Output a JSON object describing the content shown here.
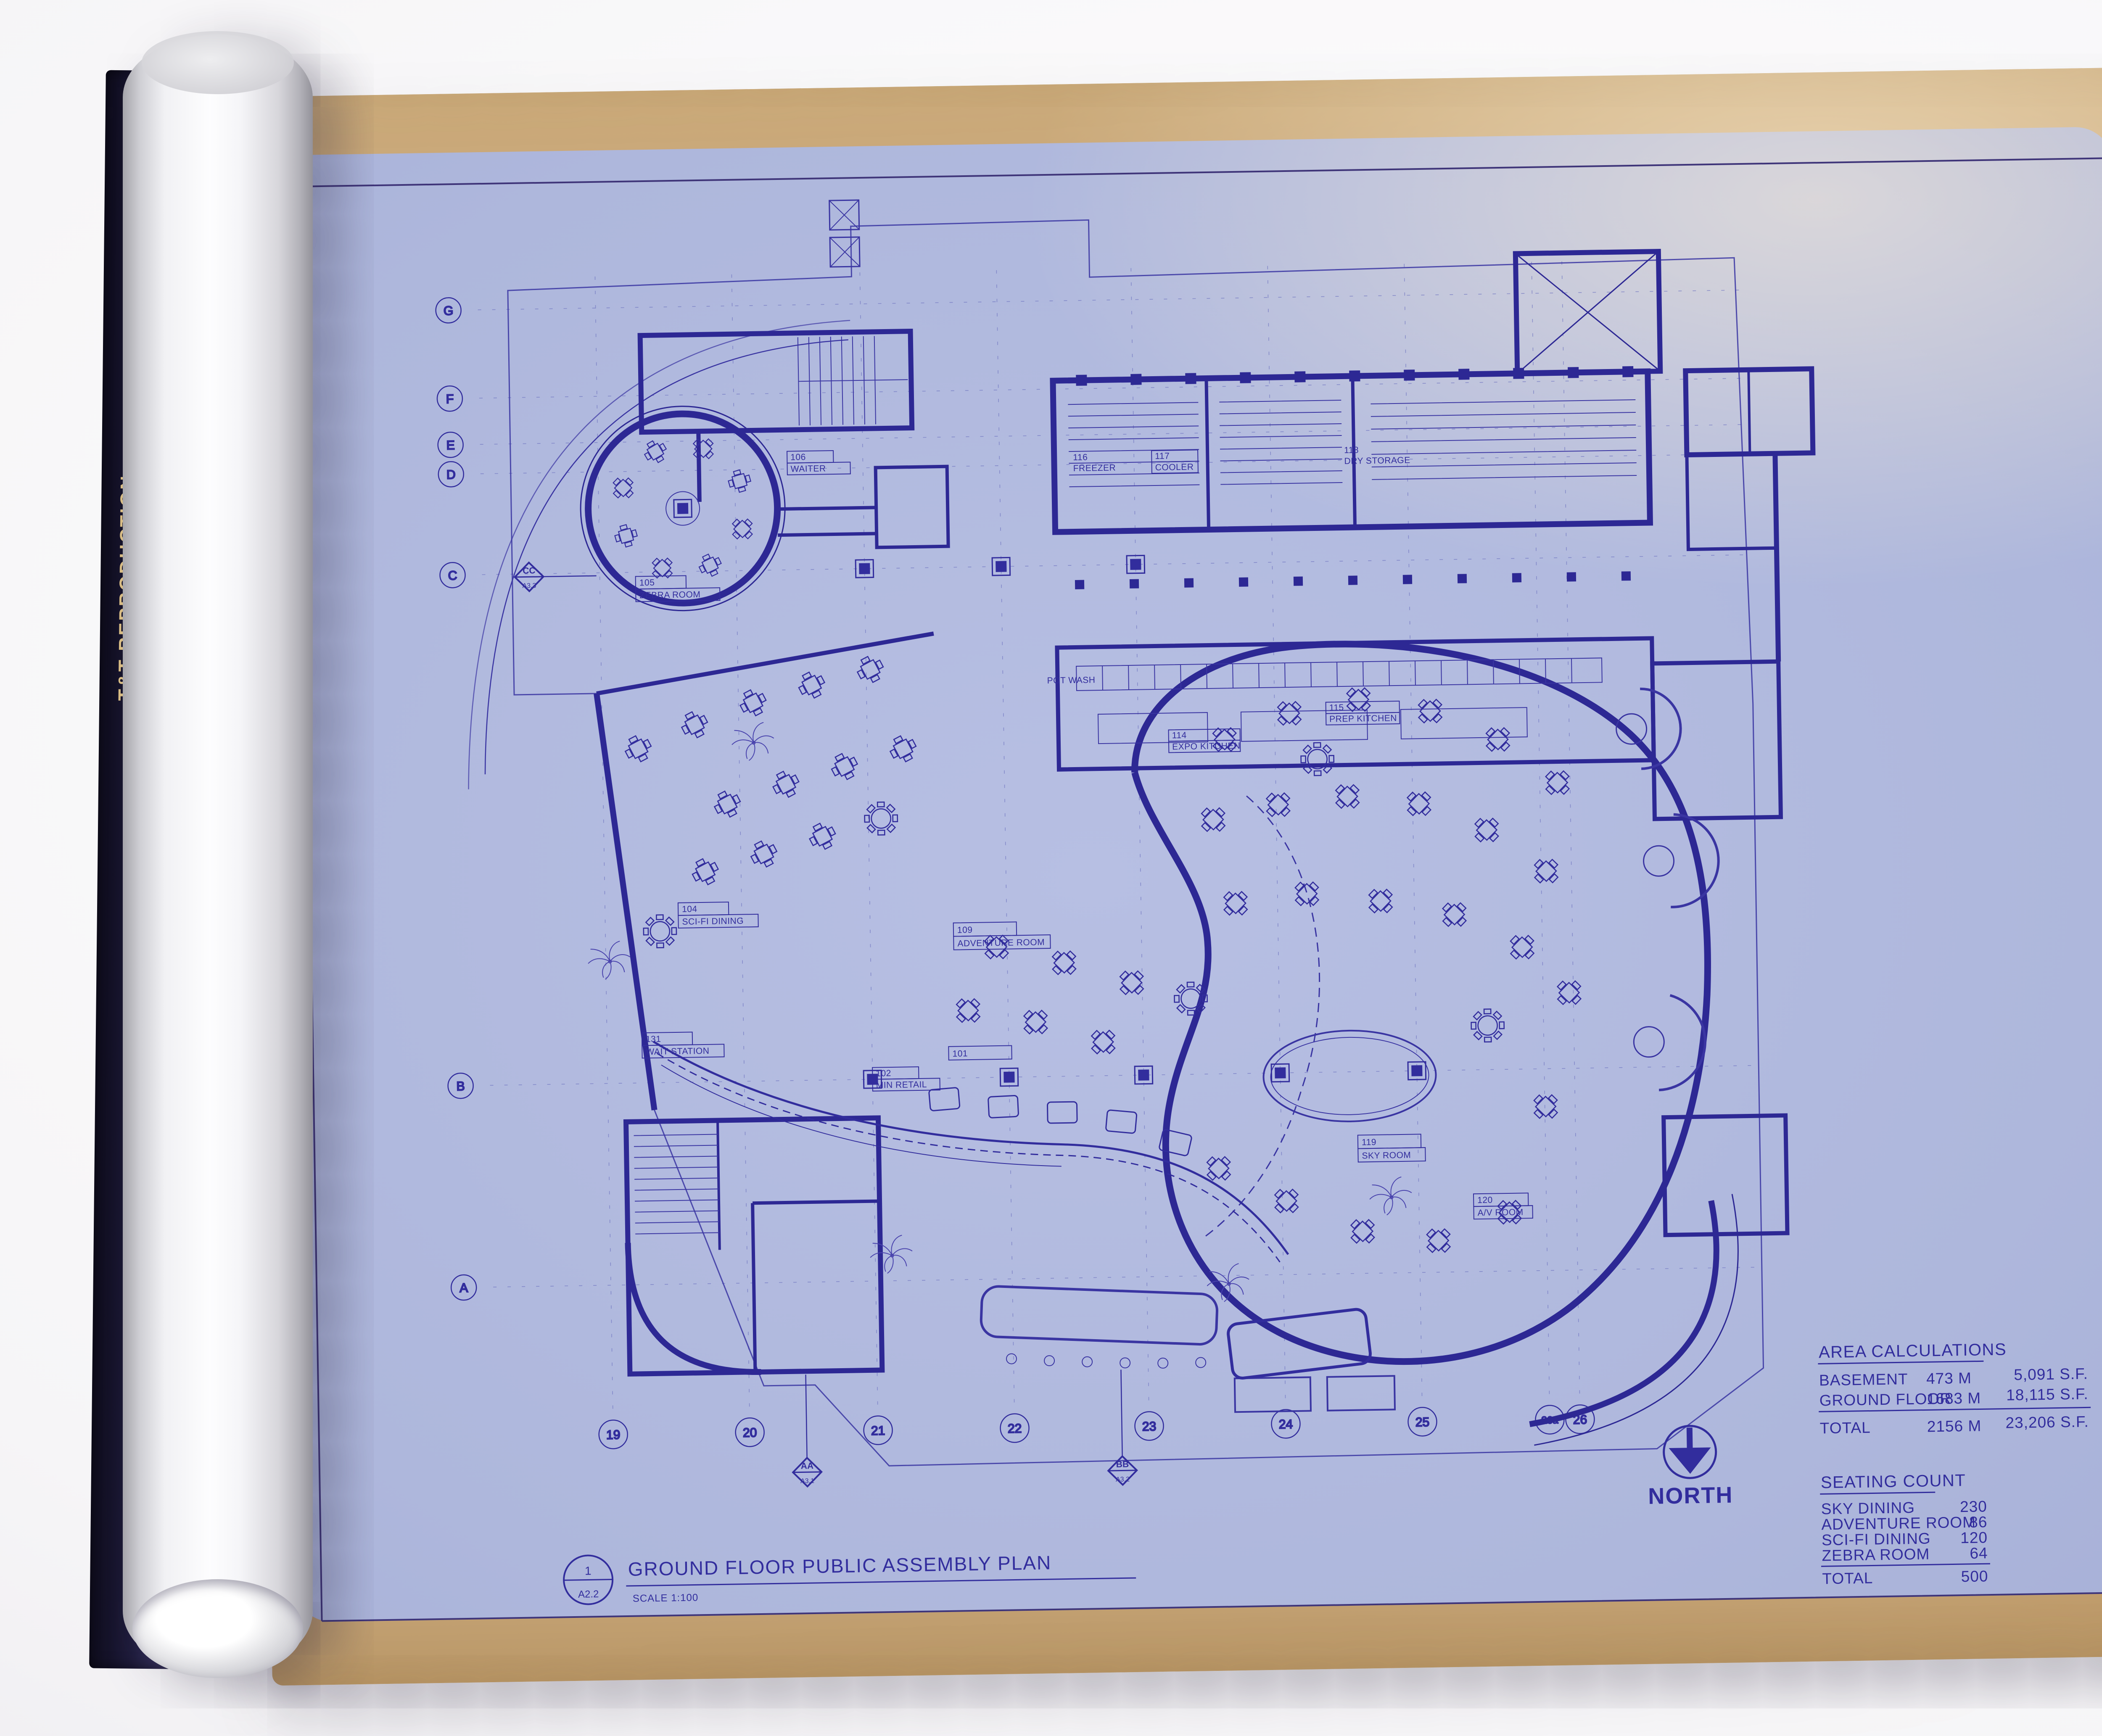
{
  "photo": {
    "spine": {
      "line1": "T&T REPRODUCTION",
      "line2": "and Supplies Inc.",
      "line3": "111 NORTH SECOND STREET"
    }
  },
  "colors": {
    "blueprint_ink": "#322d9d",
    "paper_blue": "#aeb7dc",
    "paper_tan": "#c8a678",
    "title_ink": "#53202e"
  },
  "plan": {
    "grid_columns": [
      "19",
      "20",
      "21",
      "22",
      "23",
      "24",
      "25",
      "26a",
      "26"
    ],
    "grid_rows": [
      "A",
      "B",
      "C",
      "D",
      "E",
      "F",
      "G"
    ],
    "north_label": "NORTH",
    "drawing_title": {
      "detail_number": "1",
      "detail_sheet": "A2.2",
      "title": "GROUND FLOOR PUBLIC ASSEMBLY PLAN",
      "scale": "SCALE  1:100"
    },
    "rooms": [
      {
        "number": "105",
        "name": "ZEBRA ROOM"
      },
      {
        "number": "106",
        "name": "WAITER"
      },
      {
        "number": "116",
        "name": "FREEZER"
      },
      {
        "number": "117",
        "name": "COOLER"
      },
      {
        "number": "118",
        "name": "DRY STORAGE"
      },
      {
        "number": "114",
        "name": "EXPO KITCHEN"
      },
      {
        "number": "115",
        "name": "PREP KITCHEN"
      },
      {
        "number": "",
        "name": "POT WASH"
      },
      {
        "number": "104",
        "name": "SCI-FI DINING"
      },
      {
        "number": "131",
        "name": "WAIT STATION"
      },
      {
        "number": "109",
        "name": "ADVENTURE ROOM"
      },
      {
        "number": "101",
        "name": ""
      },
      {
        "number": "102",
        "name": "MIN RETAIL"
      },
      {
        "number": "119",
        "name": "SKY ROOM"
      },
      {
        "number": "120",
        "name": "A/V ROOM"
      }
    ],
    "section_markers": [
      {
        "label": "AA",
        "sheet": "A3.1"
      },
      {
        "label": "BB",
        "sheet": "A3.2"
      },
      {
        "label": "CC",
        "sheet": "A3.3"
      }
    ]
  },
  "area_calculations": {
    "title": "AREA CALCULATIONS",
    "rows": [
      {
        "label": "BASEMENT",
        "metric": "473 M",
        "imperial": "5,091 S.F."
      },
      {
        "label": "GROUND FLOOR",
        "metric": "1683 M",
        "imperial": "18,115 S.F."
      },
      {
        "label": "TOTAL",
        "metric": "2156 M",
        "imperial": "23,206 S.F."
      }
    ]
  },
  "seating_count": {
    "title": "SEATING COUNT",
    "rows": [
      {
        "label": "SKY DINING",
        "value": "230"
      },
      {
        "label": "ADVENTURE ROOM",
        "value": "86"
      },
      {
        "label": "SCI-FI DINING",
        "value": "120"
      },
      {
        "label": "ZEBRA ROOM",
        "value": "64"
      },
      {
        "label": "TOTAL",
        "value": "500"
      }
    ]
  },
  "title_block": {
    "issue_record": {
      "title": "DRAWING ISSUE RECORD",
      "col_status": "STATUS",
      "col_date": "DATE ISSUED",
      "col_extra": "owner · mgr · use · struct · mech · plumb · elec · light · field · other",
      "rows": [
        {
          "status": "",
          "date": "3/8/96",
          "to": "PH-96"
        },
        {
          "status": "PRELIM",
          "date": "4/12/96",
          "to": "PH-96"
        },
        {
          "status": "",
          "date": "5/2/96",
          "to": ""
        },
        {
          "status": "CD",
          "date": "5-9-96",
          "to": "PH-96"
        }
      ],
      "field_note": "MCH"
    },
    "note": "NOTE: DIMENSIONS OF BUILDING MATERIALS (I.E. GYPSUM BOARD, METAL STUDS, ETC.) CONFIRM TO U.S. STANDARDS. WHERE LOCAL EQUIVALENTS DIFFER, CONSULT W/ ROCKWELL GROUP TO IDENTIFY AND COORDINATE CRITICAL DIMENSIONS",
    "note_footer": "Rockwell Architecture, Planning and Design, P.C. ©1996",
    "project_label": "PROJECT:",
    "project_name": "PLANET HOLLYWOOD",
    "project_city": "MOSCOW, RUSSIA",
    "project_number_label": "PROJECT#",
    "project_number": "96007",
    "title_label": "TITLE:",
    "title": "GROUND FLOOR PUBLIC ASSEMBLY PLAN",
    "scale_label": "Scale:",
    "scale": "1:100",
    "drawn_label": "Drn by:",
    "drawn": "BDM",
    "checked_label": "Checked by:",
    "checked": "RS",
    "firm_logo": "rockwellgroup",
    "firm_address": "Rockwell Architecture, Planning and Design, P.C. — 5 Union Square West, New York, New York 10003",
    "sheet_number": "A2.2"
  }
}
